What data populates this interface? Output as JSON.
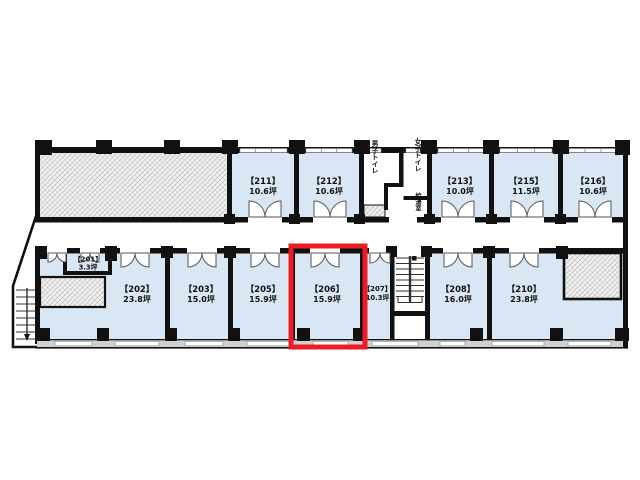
{
  "plan": {
    "type": "office-floor-plan",
    "selected_room": "206",
    "highlight_color": "#ed1c24",
    "room_fill": "#d9e6f3",
    "wall_color": "#111111",
    "area_unit": "坪",
    "rooms": {
      "201": {
        "name": "【201】",
        "area": "3.3坪"
      },
      "202": {
        "name": "【202】",
        "area": "23.8坪"
      },
      "203": {
        "name": "【203】",
        "area": "15.0坪"
      },
      "205": {
        "name": "【205】",
        "area": "15.9坪"
      },
      "206": {
        "name": "【206】",
        "area": "15.9坪"
      },
      "207": {
        "name": "【207】",
        "area": "10.3坪"
      },
      "208": {
        "name": "【208】",
        "area": "16.0坪"
      },
      "210": {
        "name": "【210】",
        "area": "23.8坪"
      },
      "211": {
        "name": "【211】",
        "area": "10.6坪"
      },
      "212": {
        "name": "【212】",
        "area": "10.6坪"
      },
      "213": {
        "name": "【213】",
        "area": "10.0坪"
      },
      "215": {
        "name": "【215】",
        "area": "11.5坪"
      },
      "216": {
        "name": "【216】",
        "area": "10.6坪"
      }
    },
    "facilities": {
      "mens_toilet": "男子トイレ",
      "womens_toilet": "女子トイレ",
      "kitchenette": "給湯室"
    }
  }
}
